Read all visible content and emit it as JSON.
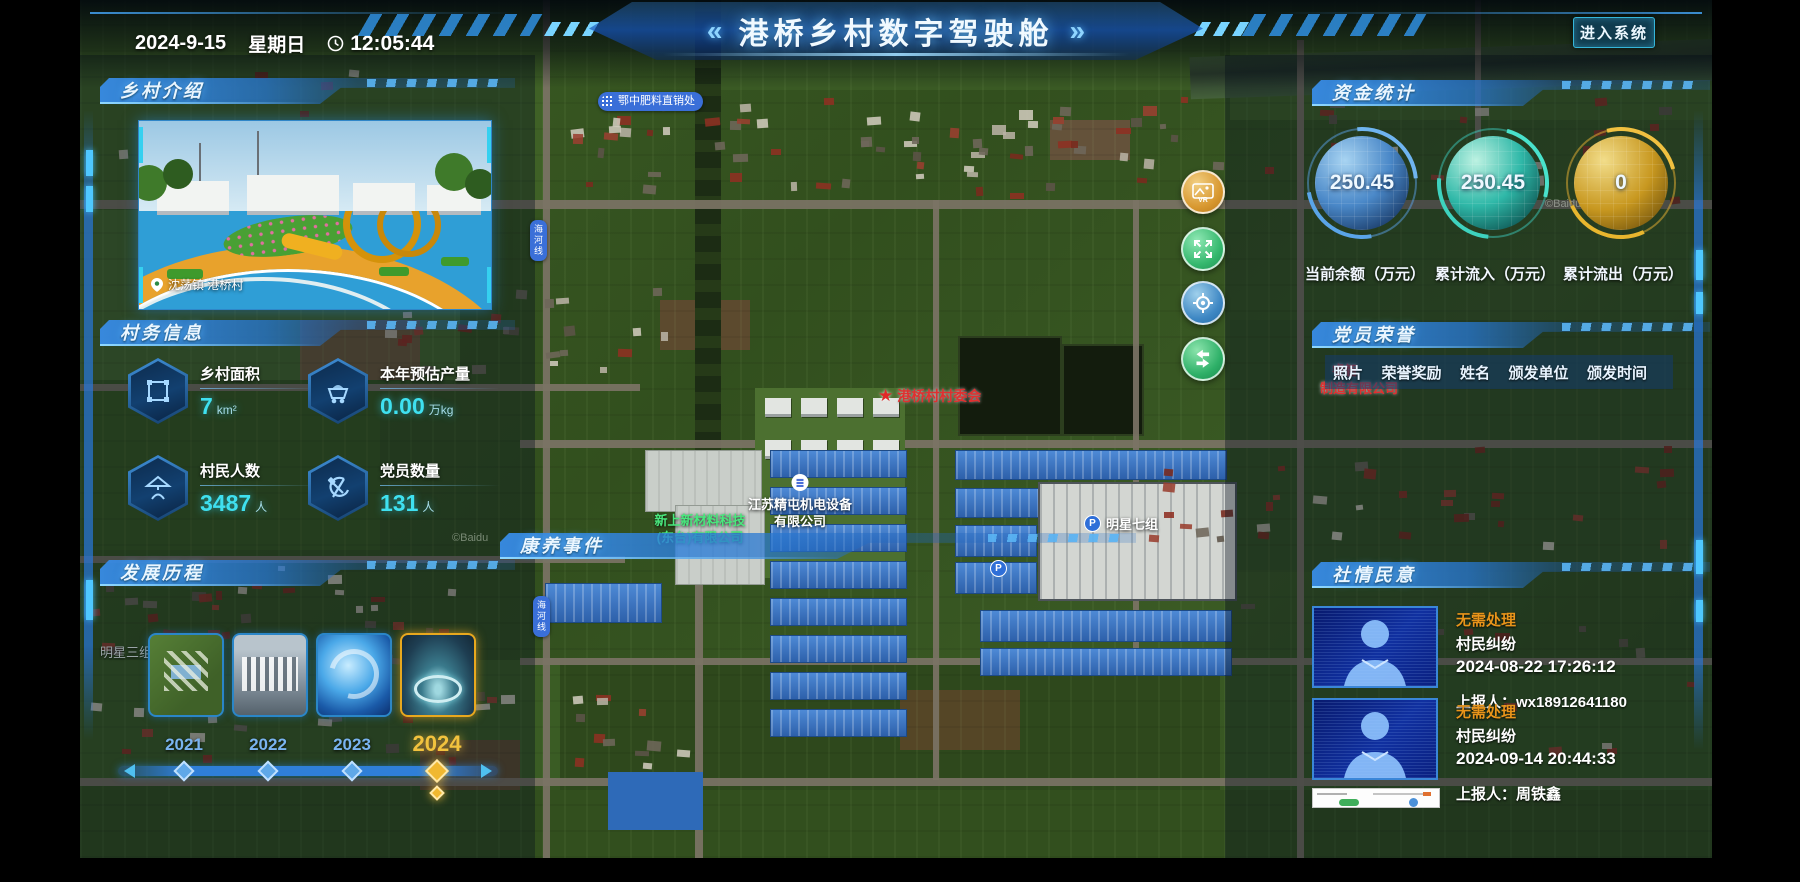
{
  "header": {
    "date": "2024-9-15",
    "weekday": "星期日",
    "time": "12:05:44",
    "chevron_left": "«",
    "chevron_right": "»",
    "title": "港桥乡村数字驾驶舱",
    "enter_button": "进入系统"
  },
  "intro": {
    "title": "乡村介绍",
    "photo_caption": "沈荡镇 港桥村"
  },
  "affairs": {
    "title": "村务信息",
    "stats": [
      {
        "label": "乡村面积",
        "value": "7",
        "unit": "km²"
      },
      {
        "label": "本年预估产量",
        "value": "0.00",
        "unit": "万kg"
      },
      {
        "label": "村民人数",
        "value": "3487",
        "unit": "人"
      },
      {
        "label": "党员数量",
        "value": "131",
        "unit": "人"
      }
    ]
  },
  "history": {
    "title": "发展历程",
    "years": [
      "2021",
      "2022",
      "2023",
      "2024"
    ],
    "selected_year": "2024"
  },
  "funds": {
    "title": "资金统计",
    "gauges": [
      {
        "value": "250.45",
        "label": "当前余额（万元）",
        "color": "#4a9de0"
      },
      {
        "value": "250.45",
        "label": "累计流入（万元）",
        "color": "#2ed9c3"
      },
      {
        "value": "0",
        "label": "累计流出（万元）",
        "color": "#d9a826"
      }
    ]
  },
  "honors": {
    "title": "党员荣誉",
    "columns": [
      "照片",
      "荣誉奖励",
      "姓名",
      "颁发单位",
      "颁发时间"
    ]
  },
  "sentiment": {
    "title": "社情民意",
    "items": [
      {
        "status": "无需处理",
        "category": "村民纠纷",
        "datetime": "2024-08-22 17:26:12",
        "reporter": "上报人：wx18912641180"
      },
      {
        "status": "无需处理",
        "category": "村民纠纷",
        "datetime": "2024-09-14 20:44:33",
        "reporter": "上报人：周铁鑫"
      }
    ]
  },
  "health": {
    "title": "康养事件"
  },
  "map": {
    "committee": "港桥村村委会",
    "fertilizer": "鄂中肥料直销处",
    "company_line1": "江苏精屯机电设备",
    "company_line2": "有限公司",
    "material_line1": "新上新材料科技",
    "material_line2": "(东台)有限公司",
    "group7": "明星七组",
    "group3": "明星三组",
    "ruizhi_line1": "睿智",
    "ruizhi_line2": "制造有限公司",
    "road1": "海河线",
    "road2": "海河线",
    "parking": "P",
    "watermark": "©Baidu"
  }
}
